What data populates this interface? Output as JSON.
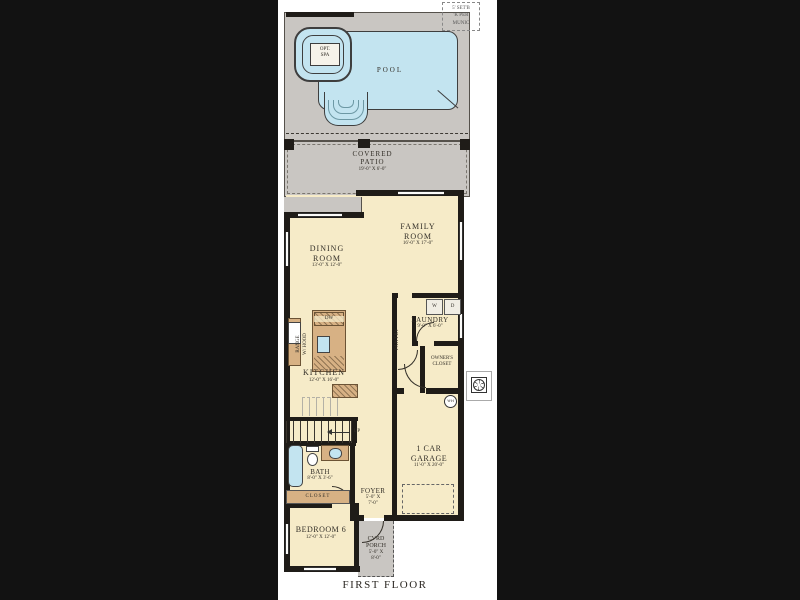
{
  "meta": {
    "caption": "FIRST FLOOR"
  },
  "site_note": {
    "line1": "5' SET'B",
    "line2": "'K PER",
    "line3": "MUNIC"
  },
  "pool_area": {
    "pool_label": "POOL",
    "spa_line1": "OPT.",
    "spa_line2": "SPA"
  },
  "rooms": {
    "covered_patio": {
      "name_line1": "COVERED",
      "name_line2": "PATIO",
      "dims": "19'-0\" X 6'-0\""
    },
    "family_room": {
      "name_line1": "FAMILY",
      "name_line2": "ROOM",
      "dims": "16'-0\" X 17'-0\""
    },
    "dining_room": {
      "name_line1": "DINING",
      "name_line2": "ROOM",
      "dims": "13'-0\" X 12'-0\""
    },
    "kitchen": {
      "name": "KITCHEN",
      "dims": "12'-0\" X 16'-0\""
    },
    "laundry": {
      "name": "LAUNDRY",
      "dims": "9'-0\" X 6'-0\""
    },
    "pantry": {
      "name": "PANTRY"
    },
    "owners_closet": {
      "name_line1": "OWNER'S",
      "name_line2": "CLOSET"
    },
    "garage": {
      "name_line1": "1 CAR",
      "name_line2": "GARAGE",
      "dims": "11'-0\" X 20'-0\""
    },
    "bath": {
      "name": "BATH",
      "dims": "8'-0\" X 3'-6\""
    },
    "closet": {
      "name": "CLOSET"
    },
    "foyer": {
      "name": "FOYER",
      "dims_line1": "5'-0\" X",
      "dims_line2": "7'-0\""
    },
    "bedroom6": {
      "name": "BEDROOM 6",
      "dims": "12'-0\" X 12'-0\""
    },
    "cvrd_porch": {
      "name_line1": "CVRD",
      "name_line2": "PORCH",
      "dims_line1": "5'-0\" X",
      "dims_line2": "8'-0\""
    }
  },
  "fixtures": {
    "washer": "W",
    "dryer": "D",
    "dishwasher": "DW",
    "range_line1": "RANGE",
    "range_line2": "W/ HOOD",
    "water_heater": "WH",
    "stairs_direction": "UP"
  },
  "colors": {
    "background": "#121212",
    "paper": "#ffffff",
    "room_fill": "#f6ebc8",
    "hardscape": "#c9c6c2",
    "water": "#c3e4f0",
    "cabinet": "#d7b184",
    "wall": "#1f1c18"
  }
}
